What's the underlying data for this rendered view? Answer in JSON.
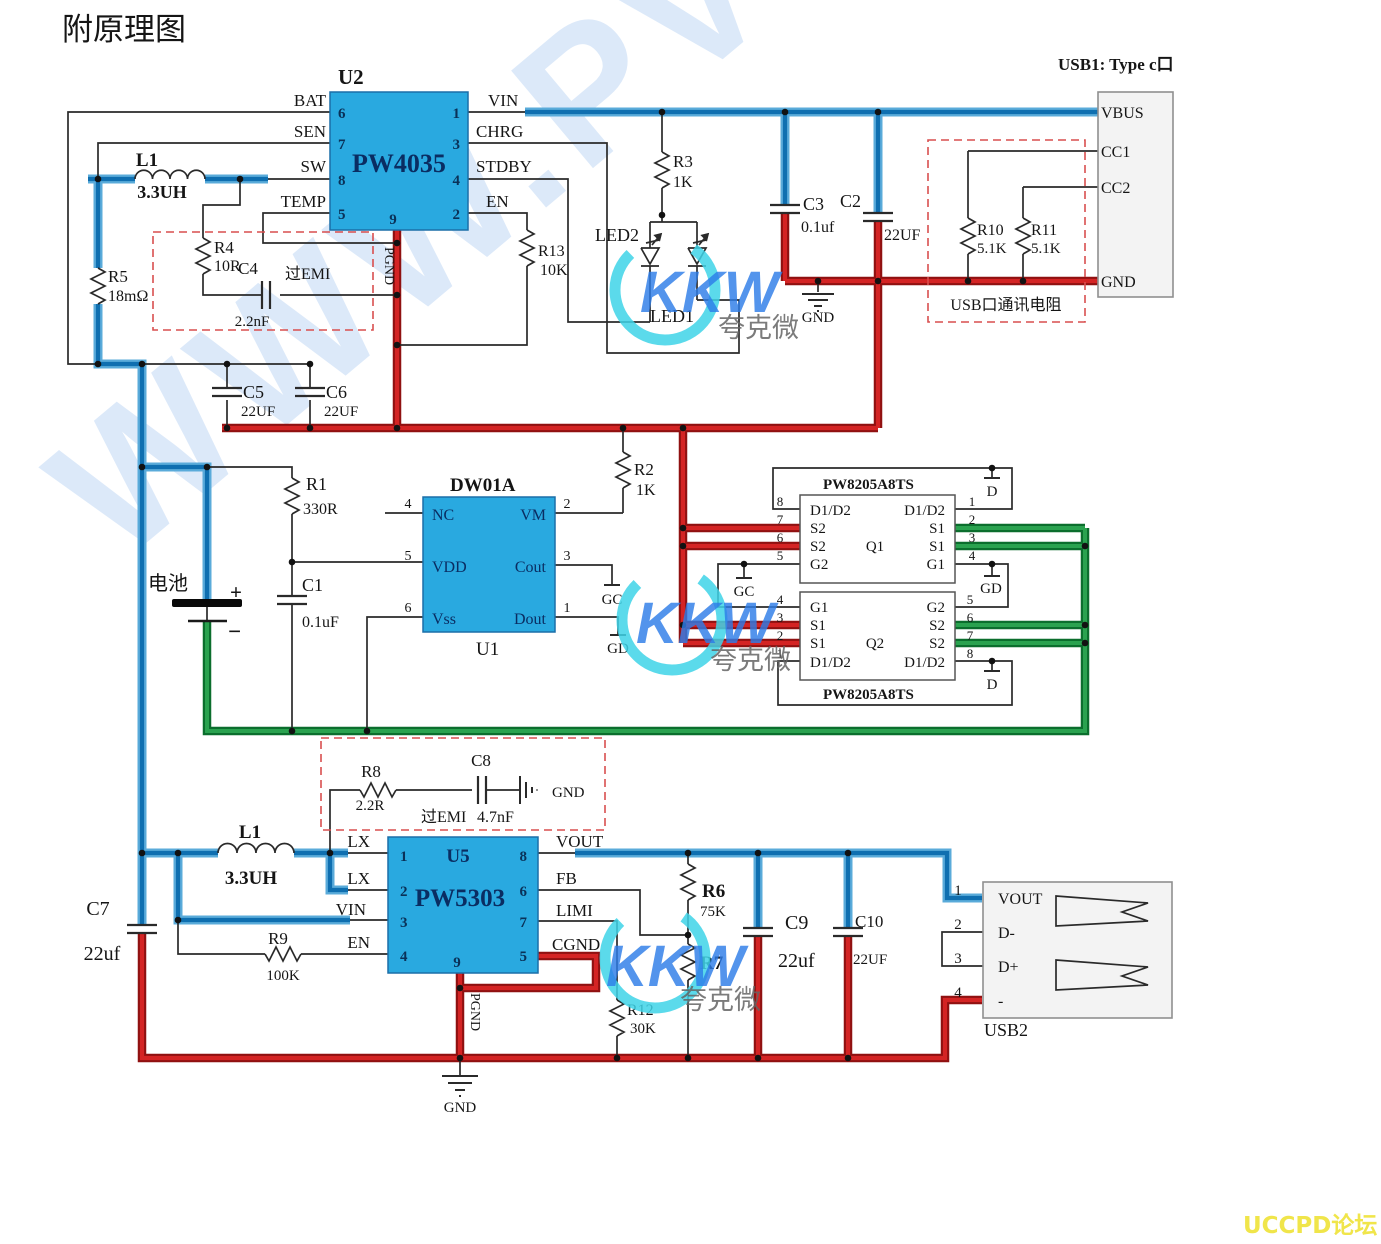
{
  "title": "附原理图",
  "watermark": {
    "diagonal": "WWW.PV",
    "logo": "KKW",
    "logo_sub": "夸克微",
    "forum": "UCCPD论坛"
  },
  "colors": {
    "trace_blue": "#0f6fb0",
    "trace_red": "#d42424",
    "trace_green": "#2aa24f",
    "chip_fill": "#29a9e0",
    "dashed_box": "#d94f4f",
    "forum_yellow": "#f0e54a"
  },
  "nums": {
    "1": "1",
    "2": "2",
    "3": "3",
    "4": "4",
    "5": "5",
    "6": "6",
    "7": "7",
    "8": "8",
    "9": "9"
  },
  "nets": {
    "gc": "GC",
    "gd": "GD",
    "d": "D",
    "gnd": "GND",
    "pgnd": "PGND"
  },
  "u2": {
    "ref": "U2",
    "part": "PW4035",
    "bat": "BAT",
    "sen": "SEN",
    "sw": "SW",
    "temp": "TEMP",
    "vin": "VIN",
    "chrg": "CHRG",
    "stdby": "STDBY",
    "en": "EN"
  },
  "u1": {
    "ref": "U1",
    "part": "DW01A",
    "nc": "NC",
    "vdd": "VDD",
    "vss": "Vss",
    "vm": "VM",
    "cout": "Cout",
    "dout": "Dout"
  },
  "u5": {
    "ref": "U5",
    "part": "PW5303",
    "lx": "LX",
    "vin": "VIN",
    "en": "EN",
    "vout": "VOUT",
    "fb": "FB",
    "limi": "LIMI",
    "cgnd": "CGND"
  },
  "q1": {
    "ref": "Q1",
    "part": "PW8205A8TS",
    "d12": "D1/D2",
    "s1": "S1",
    "s2": "S2",
    "g1": "G1",
    "g2": "G2"
  },
  "q2": {
    "ref": "Q2",
    "part": "PW8205A8TS",
    "d12": "D1/D2",
    "s1": "S1",
    "s2": "S2",
    "g1": "G1",
    "g2": "G2"
  },
  "parts": {
    "l1_top": {
      "ref": "L1",
      "val": "3.3UH"
    },
    "l1_bot": {
      "ref": "L1",
      "val": "3.3UH"
    },
    "r1": {
      "ref": "R1",
      "val": "330R"
    },
    "r2": {
      "ref": "R2",
      "val": "1K"
    },
    "r3": {
      "ref": "R3",
      "val": "1K"
    },
    "r4": {
      "ref": "R4",
      "val": "10R"
    },
    "r5": {
      "ref": "R5",
      "val": "18mΩ"
    },
    "r6": {
      "ref": "R6",
      "val": "75K"
    },
    "r7": {
      "ref": "R7"
    },
    "r8": {
      "ref": "R8",
      "val": "2.2R"
    },
    "r9": {
      "ref": "R9",
      "val": "100K"
    },
    "r10": {
      "ref": "R10",
      "val": "5.1K"
    },
    "r11": {
      "ref": "R11",
      "val": "5.1K"
    },
    "r12": {
      "ref": "R12",
      "val": "30K"
    },
    "r13": {
      "ref": "R13",
      "val": "10K"
    },
    "c1": {
      "ref": "C1",
      "val": "0.1uF"
    },
    "c2": {
      "ref": "C2",
      "val": "22UF"
    },
    "c3": {
      "ref": "C3",
      "val": "0.1uf"
    },
    "c4": {
      "ref": "C4",
      "val": "2.2nF"
    },
    "c5": {
      "ref": "C5",
      "val": "22UF"
    },
    "c6": {
      "ref": "C6",
      "val": "22UF"
    },
    "c7": {
      "ref": "C7",
      "val": "22uf"
    },
    "c8": {
      "ref": "C8",
      "val": "4.7nF"
    },
    "c9": {
      "ref": "C9",
      "val": "22uf"
    },
    "c10": {
      "ref": "C10",
      "val": "22UF"
    },
    "led1": {
      "ref": "LED1"
    },
    "led2": {
      "ref": "LED2"
    },
    "battery": {
      "label": "电池",
      "plus": "+",
      "minus": "−"
    }
  },
  "emi": {
    "label1": "过EMI",
    "label2": "过EMI"
  },
  "usb1": {
    "title": "USB1: Type c口",
    "vbus": "VBUS",
    "cc1": "CC1",
    "cc2": "CC2",
    "gnd": "GND",
    "note": "USB口通讯电阻"
  },
  "usb2": {
    "ref": "USB2",
    "vout": "VOUT",
    "dminus": "D-",
    "dplus": "D+",
    "minus": "-"
  }
}
